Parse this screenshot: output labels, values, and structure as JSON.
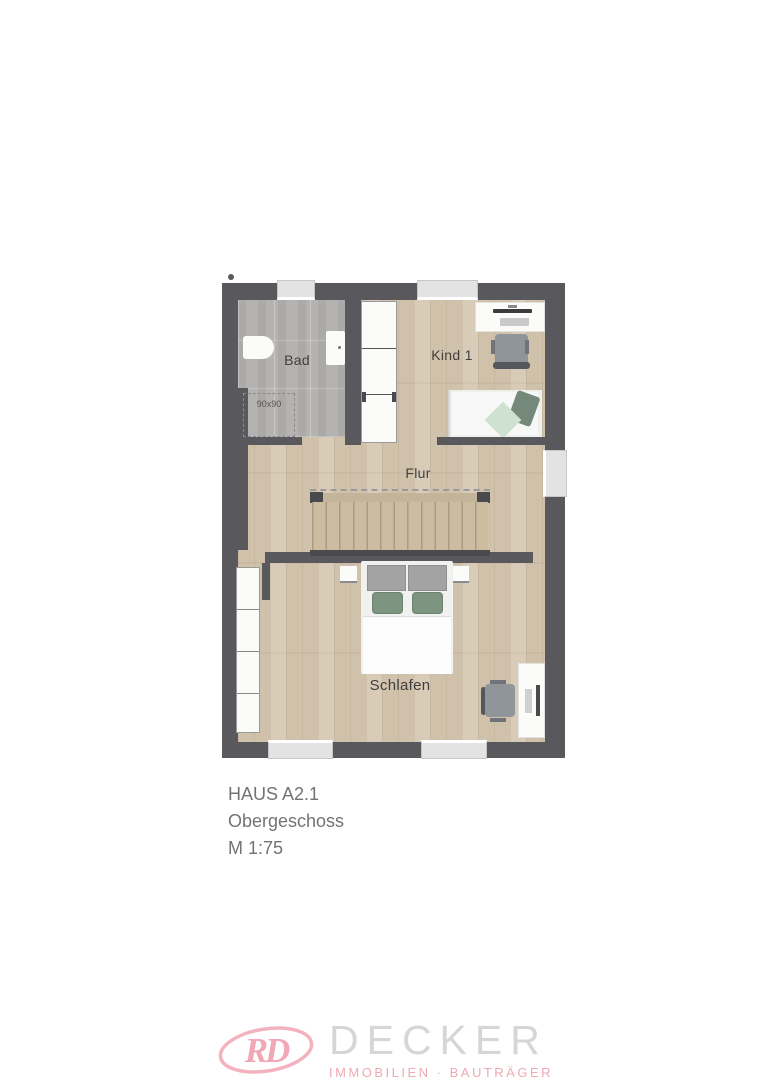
{
  "floor_plan": {
    "room_labels": {
      "bad": "Bad",
      "kind1": "Kind 1",
      "flur": "Flur",
      "schlafen": "Schlafen"
    },
    "shower_label": "90x90",
    "colors": {
      "wall": "#59595d",
      "wood_floor": "#d0c1aa",
      "tile_floor": "#b5b3b1",
      "window": "#e3e3e3",
      "stair_treads": "#ccbda1",
      "pillow_green": "#7d947f",
      "pillow_light_green": "#cfe2d2",
      "label_text": "#3f3f3f"
    }
  },
  "title_block": {
    "house": "HAUS A2.1",
    "floor": "Obergeschoss",
    "scale": "M 1:75"
  },
  "brand": {
    "monogram": "RD",
    "company": "DECKER",
    "tagline": "IMMOBILIEN · BAUTRÄGER",
    "pink": "#f2adb8",
    "light_gray": "#d6d6d6"
  }
}
